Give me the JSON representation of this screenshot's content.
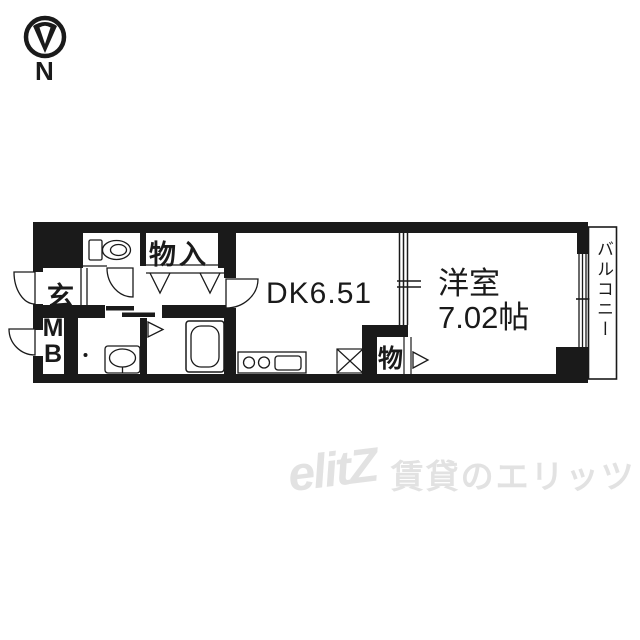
{
  "compass": {
    "north": "N"
  },
  "plan": {
    "labels": {
      "entrance": "玄",
      "meter_box_line1": "M",
      "meter_box_line2": "B",
      "closet": "物入",
      "dining_kitchen": "DK6.51",
      "western_room_name": "洋室",
      "western_room_size": "7.02帖",
      "storage": "物",
      "balcony": "バルコニー"
    },
    "colors": {
      "wall": "#1a1a1a",
      "floor": "#ffffff"
    }
  },
  "watermark": {
    "logo": "elitZ",
    "text": "賃貸のエリッツ",
    "color": "#e2e2e2"
  }
}
